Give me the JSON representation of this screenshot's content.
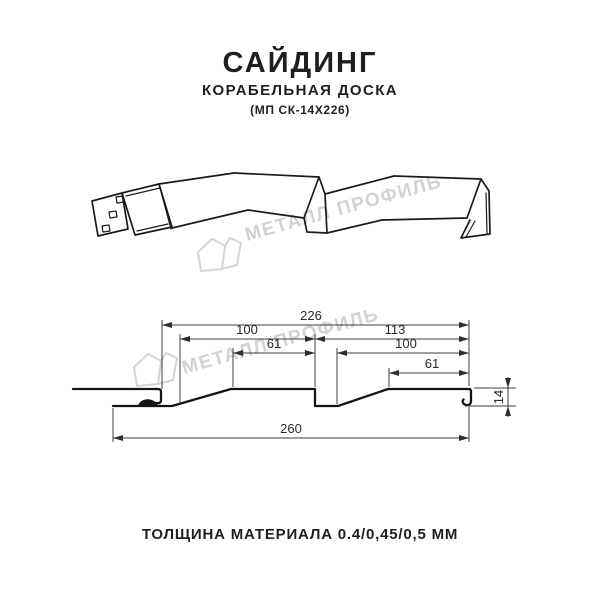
{
  "header": {
    "title": "САЙДИНГ",
    "subtitle": "КОРАБЕЛЬНАЯ ДОСКА",
    "model": "(МП СК-14Х226)"
  },
  "watermark": {
    "brand": "МЕТАЛЛ ПРОФИЛЬ"
  },
  "cross_section": {
    "dim_top_overall": "226",
    "dim_left_pitch": "100",
    "dim_left_flat": "61",
    "dim_right_pitch": "113",
    "dim_right_inner": "100",
    "dim_right_flat": "61",
    "dim_height": "14",
    "dim_bottom_overall": "260"
  },
  "footer": {
    "thickness": "ТОЛЩИНА МАТЕРИАЛА 0.4/0,45/0,5 ММ"
  },
  "colors": {
    "profile_line": "#141414",
    "dimension_line": "#3c3c3c",
    "watermark": "#d2d2d2",
    "text": "#1f1f1f",
    "background": "#ffffff"
  }
}
